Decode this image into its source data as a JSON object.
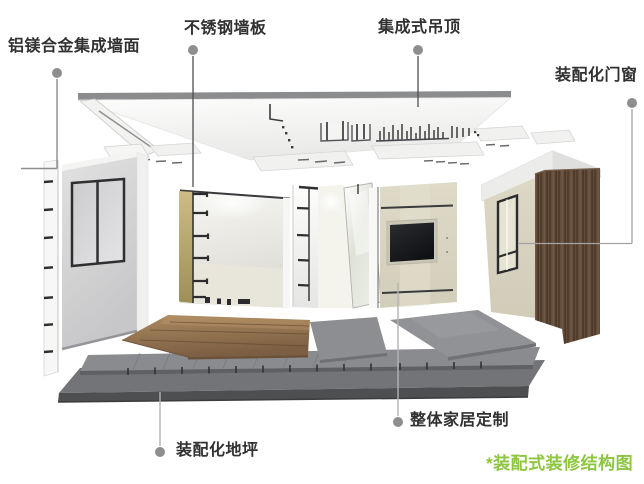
{
  "diagram": {
    "caption": "*装配式装修结构图",
    "caption_style": "color:#8dc63f",
    "colors": {
      "accent_green": "#8dc63f",
      "label_text": "#313131",
      "leader_gray": "#8e8e90",
      "ceiling_band": "#8b8c8e",
      "wall_gray": "#d5d5d7",
      "keel_yellow": "#b9a96e",
      "wood_door_brown": "#5d4736",
      "wood_floor_brown": "#96774f",
      "floor_base_dark": "#4e4f51"
    },
    "callouts": [
      {
        "id": "aluminum-wall",
        "label": "铝镁合金集成墙面"
      },
      {
        "id": "stainless-panel",
        "label": "不锈钢墙板"
      },
      {
        "id": "ceiling",
        "label": "集成式吊顶"
      },
      {
        "id": "door-window",
        "label": "装配化门窗"
      },
      {
        "id": "floor",
        "label": "装配化地坪"
      },
      {
        "id": "furniture",
        "label": "整体家居定制"
      }
    ]
  }
}
